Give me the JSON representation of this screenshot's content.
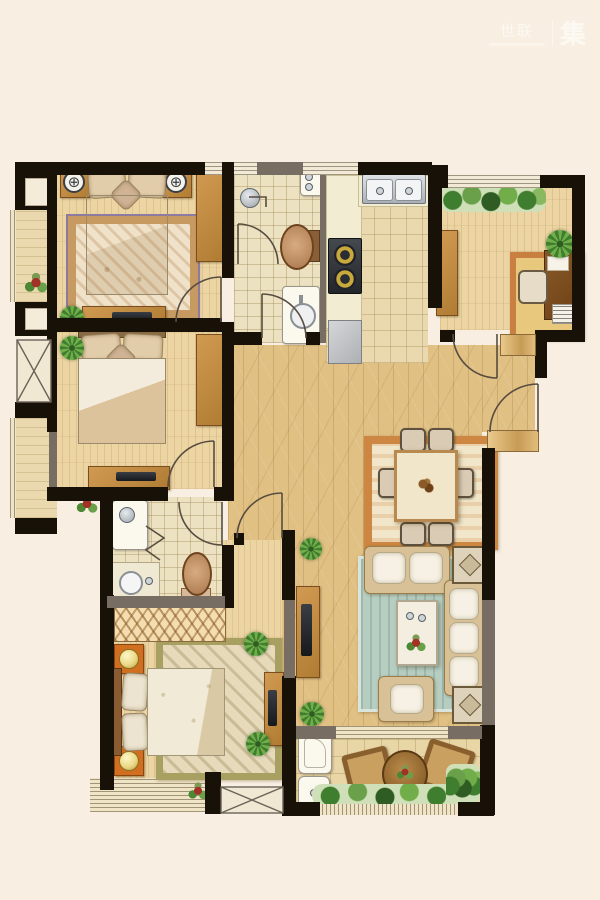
{
  "watermark": {
    "brand_left": "世联",
    "divider": "|",
    "brand_right": "集"
  },
  "icons": {
    "ceiling_lamp_dial": "⊕"
  },
  "palette": {
    "bg": "#f8efe2",
    "wall": "#181108",
    "wall2": "#786d63",
    "win": "#f2ead6",
    "floor-plank": "#e1c083",
    "floor-room": "#ecd5a3",
    "floor-bath": "#ece1c0",
    "floor-balc": "#e9d6a7",
    "bay": "#ead9ae",
    "wood-d": "#7c4e1d",
    "sofa": "#d8c197",
    "linen": "#e2cdab",
    "lamp": "#ead987",
    "rug_teal": "#b6cec2",
    "rug_warm": "#cd8743",
    "orange": "#d06f1f",
    "green": "#4c8733",
    "steel": "#c9ced2",
    "arc": "#584d41"
  },
  "floor_plan": {
    "type": "residential-apartment-top-view",
    "rooms": [
      {
        "name": "bedroom-northwest",
        "furniture": [
          "double-bed",
          "nightstand-left",
          "nightstand-right",
          "ceiling-lamp-dial",
          "area-rug",
          "wardrobe",
          "dresser-tv"
        ]
      },
      {
        "name": "bathroom-shared",
        "furniture": [
          "shower-head",
          "toilet",
          "vanity-sink",
          "wall-cabinet"
        ]
      },
      {
        "name": "kitchen",
        "furniture": [
          "double-sink",
          "gas-stove",
          "counter",
          "refrigerator"
        ]
      },
      {
        "name": "study",
        "furniture": [
          "desk",
          "desk-chair",
          "bookstack",
          "cabinet",
          "area-rug",
          "potted-plant",
          "planter-bed"
        ]
      },
      {
        "name": "bedroom-west",
        "furniture": [
          "double-bed",
          "wardrobe",
          "dresser-tv",
          "potted-plant"
        ]
      },
      {
        "name": "dining-area",
        "furniture": [
          "dining-table",
          "dining-chairs-x6",
          "area-rug"
        ]
      },
      {
        "name": "living-room",
        "furniture": [
          "loveseat",
          "three-seat-sofa",
          "armchair",
          "coffee-table",
          "side-table-x2",
          "tv-cabinet",
          "teal-rug",
          "potted-plants"
        ]
      },
      {
        "name": "master-bedroom",
        "furniture": [
          "double-bed",
          "nightstand-x2",
          "closet-hatched",
          "area-rug",
          "tv-cabinet",
          "bay-window",
          "potted-plants"
        ]
      },
      {
        "name": "ensuite-bathroom",
        "furniture": [
          "shower-stall",
          "vanity-sink",
          "toilet"
        ]
      },
      {
        "name": "balcony-south",
        "furniture": [
          "washing-machine",
          "laundry-sink",
          "wicker-chair-x2",
          "round-table",
          "greenery"
        ]
      },
      {
        "name": "bay-window-west",
        "furniture": [
          "flower-pot"
        ]
      },
      {
        "name": "ac-platform-west",
        "furniture": []
      },
      {
        "name": "ac-platform-south",
        "furniture": []
      },
      {
        "name": "entry",
        "furniture": [
          "entry-door"
        ]
      }
    ]
  }
}
